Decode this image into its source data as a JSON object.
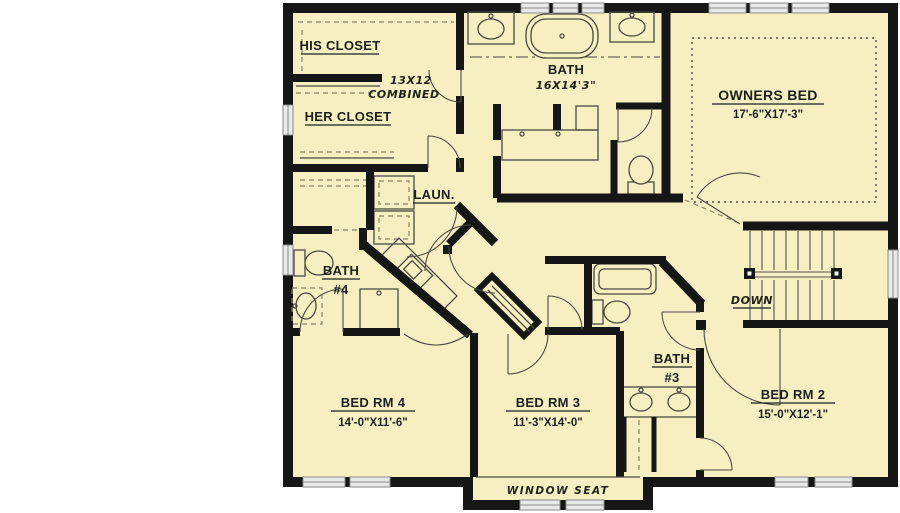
{
  "colors": {
    "floor": "#f6efc1",
    "wall": "#161616",
    "linework": "#4c4a40",
    "window": "#e9e9e9",
    "background": "#ffffff"
  },
  "rooms": {
    "his_closet": {
      "label": "HIS CLOSET"
    },
    "combined": {
      "line1": "13X12",
      "line2": "COMBINED"
    },
    "her_closet": {
      "label": "HER CLOSET"
    },
    "owners_bath": {
      "label": "BATH",
      "dims": "16X14'3\""
    },
    "owners_bed": {
      "label": "OWNERS BED",
      "dims": "17'-6\"X17'-3\""
    },
    "laundry": {
      "label": "LAUN."
    },
    "bath4": {
      "label": "BATH",
      "number": "#4"
    },
    "stairs": {
      "label": "DOWN"
    },
    "bed4": {
      "label": "BED RM 4",
      "dims": "14'-0\"X11'-6\""
    },
    "bed3": {
      "label": "BED RM 3",
      "dims": "11'-3\"X14'-0\""
    },
    "bath3": {
      "label": "BATH",
      "number": "#3"
    },
    "bed2": {
      "label": "BED RM 2",
      "dims": "15'-0\"X12'-1\""
    },
    "window_seat": {
      "label": "WINDOW SEAT"
    }
  }
}
